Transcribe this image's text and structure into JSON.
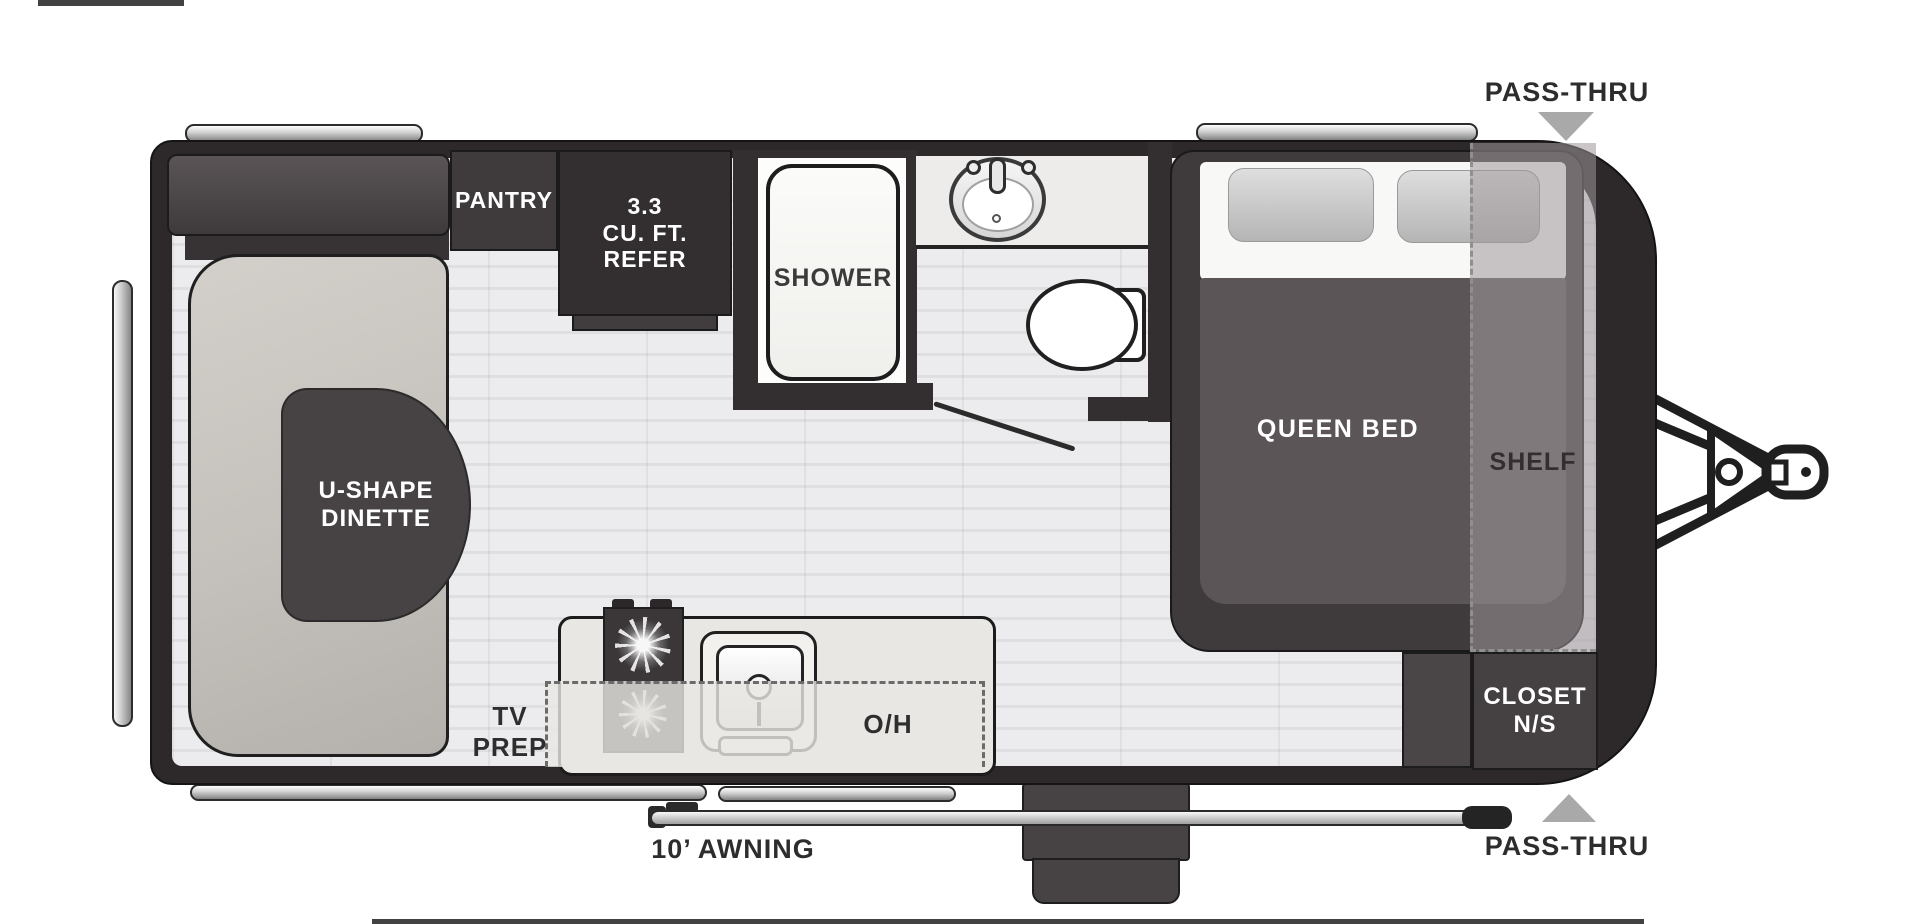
{
  "title": "Travel trailer floor plan",
  "exterior": {
    "pass_thru_top": "PASS-THRU",
    "pass_thru_bottom": "PASS-THRU",
    "awning": "10’ AWNING"
  },
  "rooms": {
    "pantry": "PANTRY",
    "refer": {
      "line1": "3.3",
      "line2": "CU. FT.",
      "line3": "REFER"
    },
    "shower": "SHOWER",
    "dinette": {
      "line1": "U-SHAPE",
      "line2": "DINETTE"
    },
    "tv_prep": {
      "line1": "TV",
      "line2": "PREP"
    },
    "overhead": "O/H",
    "queen_bed": "QUEEN BED",
    "shelf": "SHELF",
    "closet": {
      "line1": "CLOSET",
      "line2": "N/S"
    }
  },
  "colors": {
    "body_wall": "#2d292a",
    "cabinet_dark": "#403b3d",
    "refer_dark": "#332f31",
    "bed_blanket": "#5b5557",
    "bench": "#c8c4bf",
    "floor": "#ececee",
    "floor_alt": "#dfdfe2",
    "counter": "#e9e7e3",
    "overlay_gray": "#9e989a",
    "pass_thru_arrow": "#a9a9a9",
    "label_dark": "#2d2d2d",
    "label_white": "#ffffff"
  }
}
